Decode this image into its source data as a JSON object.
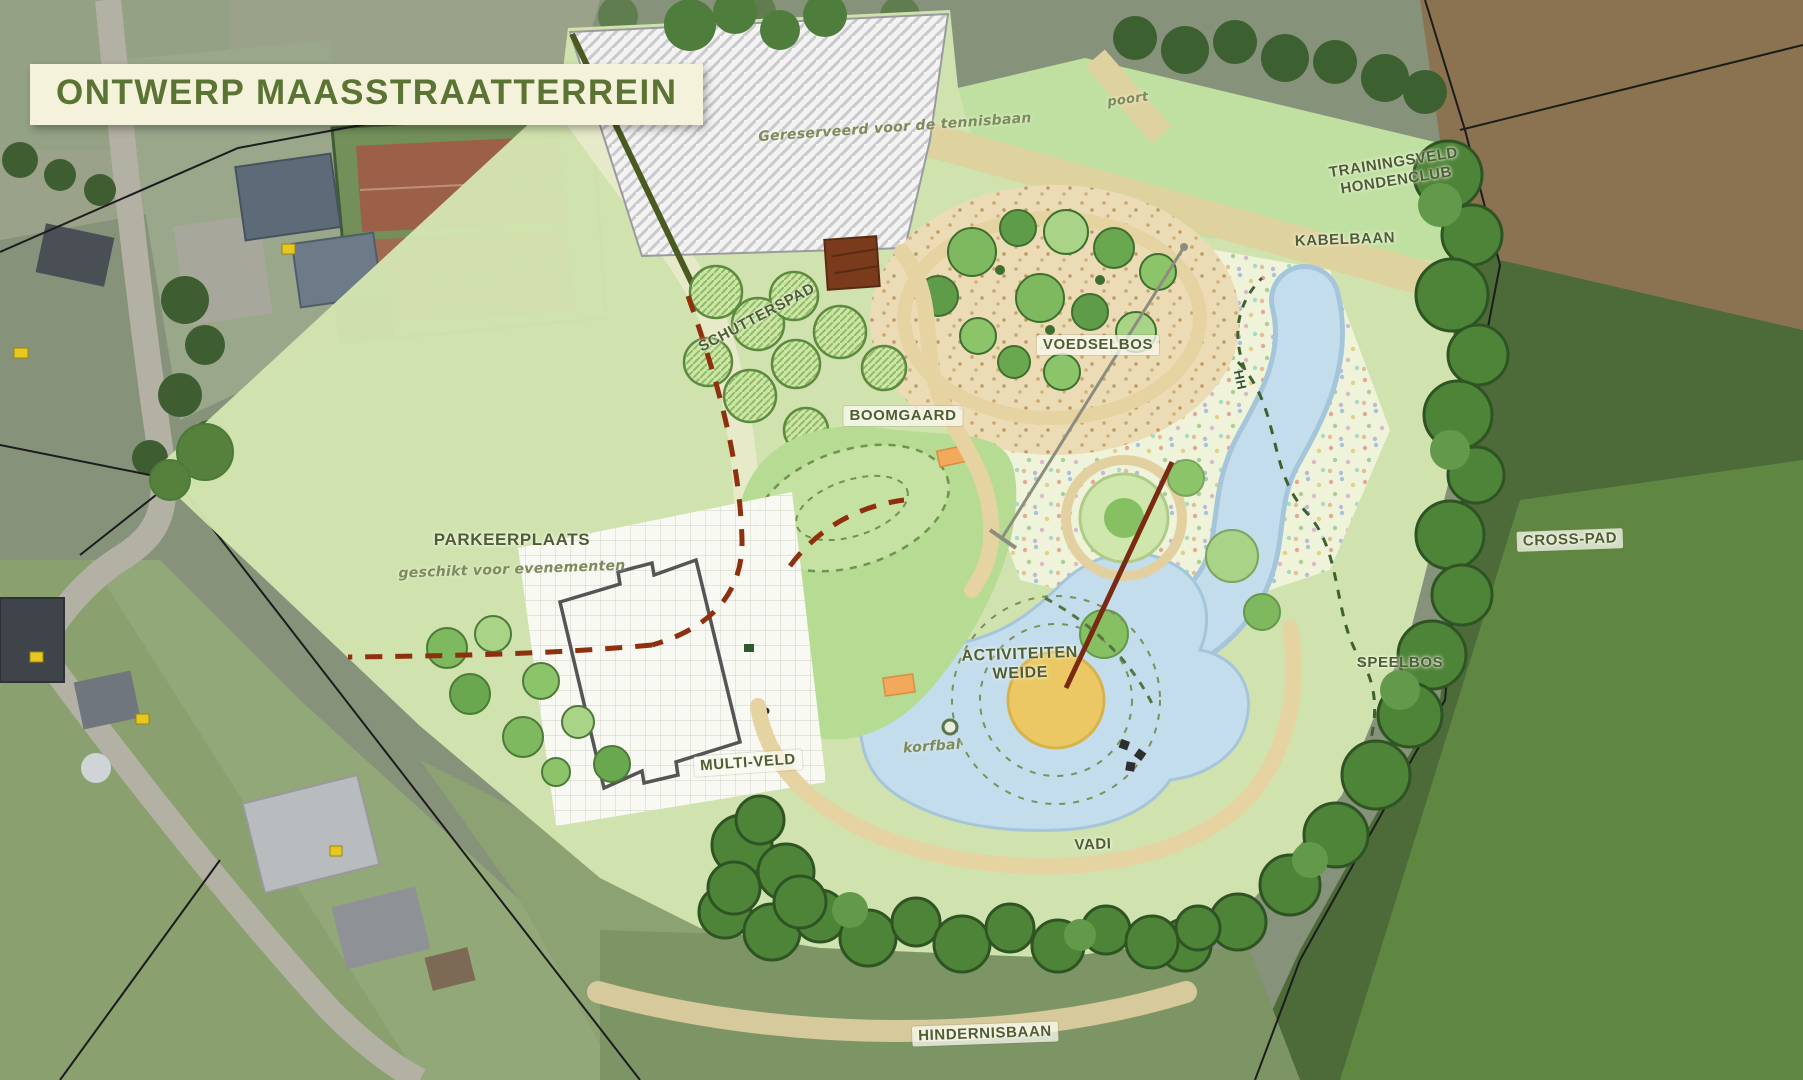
{
  "title": {
    "text": "ONTWERP MAASSTRAATTERREIN"
  },
  "areas": {
    "reserved": {
      "label": "Gereserveerd voor de tennisbaan"
    },
    "poort": {
      "label": "poort"
    },
    "trainingsveld": {
      "line1": "TRAININGSVELD",
      "line2": "HONDENCLUB"
    },
    "kabelbaan": {
      "label": "KABELBAAN"
    },
    "voedselbos": {
      "label": "VOEDSELBOS"
    },
    "boomgaard": {
      "label": "BOOMGAARD"
    },
    "schutterspad": {
      "label": "SCHUTTERSPAD"
    },
    "parkeerplaats": {
      "label": "PARKEERPLAATS",
      "sublabel": "geschikt voor evenementen"
    },
    "multiveld": {
      "label": "MULTI-VELD"
    },
    "activiteitenweide": {
      "line1": "ACTIVITEITEN",
      "line2": "WEIDE"
    },
    "korfbal": {
      "label": "korfbal"
    },
    "vadi": {
      "label": "VADI"
    },
    "speelbos": {
      "label": "SPEELBOS"
    },
    "crosspad": {
      "label": "CROSS-PAD"
    },
    "hindernisbaan": {
      "label": "HINDERNISBAAN"
    },
    "bridge": {
      "label": "HH"
    }
  },
  "colors": {
    "title_green": "#5c7433",
    "banner_bg": "#f5f2dc",
    "label_olive": "#4e5d33",
    "plan_green": "#d3e4b0",
    "field_green": "#bfe0a0",
    "activity_green": "#b6db92",
    "path_sand": "#e6d3a2",
    "water_blue": "#c3ddec",
    "vadi_sand": "#ebc863",
    "tree_dark": "#4e8438",
    "fence_red": "#8e2f0e"
  }
}
